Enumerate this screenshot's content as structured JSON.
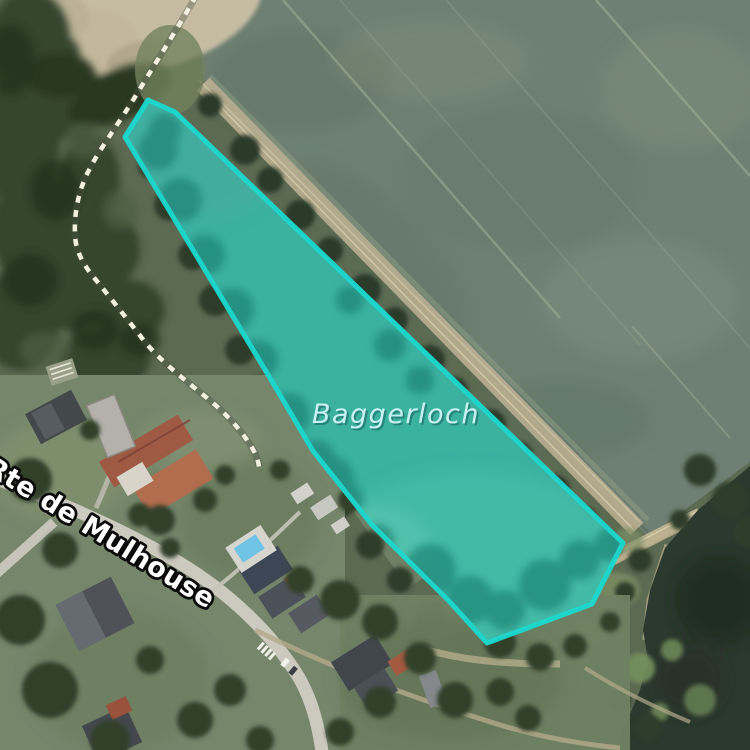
{
  "map": {
    "labels": {
      "water_name": "Baggerloch",
      "road_name": "Rte de Mulhouse"
    },
    "selected_area": {
      "name": "Baggerloch",
      "points": "125,137 148,100 175,112 623,543 592,604 487,643 449,601 372,525 313,451 270,378",
      "stroke": "#1bd8cf",
      "fill": "#2edcc9",
      "fill_opacity": "0.2"
    },
    "palette": {
      "field": "#6e8073",
      "woods": "#36452f",
      "lake_water": "#3fa797",
      "dark_lake": "#2b392e",
      "road": "#ccc9bf",
      "dirt": "#c6bca3",
      "footpath_dash": "#f4f0e0",
      "water_label_color": "#c9f1f3",
      "road_label_color": "#ffffff"
    }
  }
}
